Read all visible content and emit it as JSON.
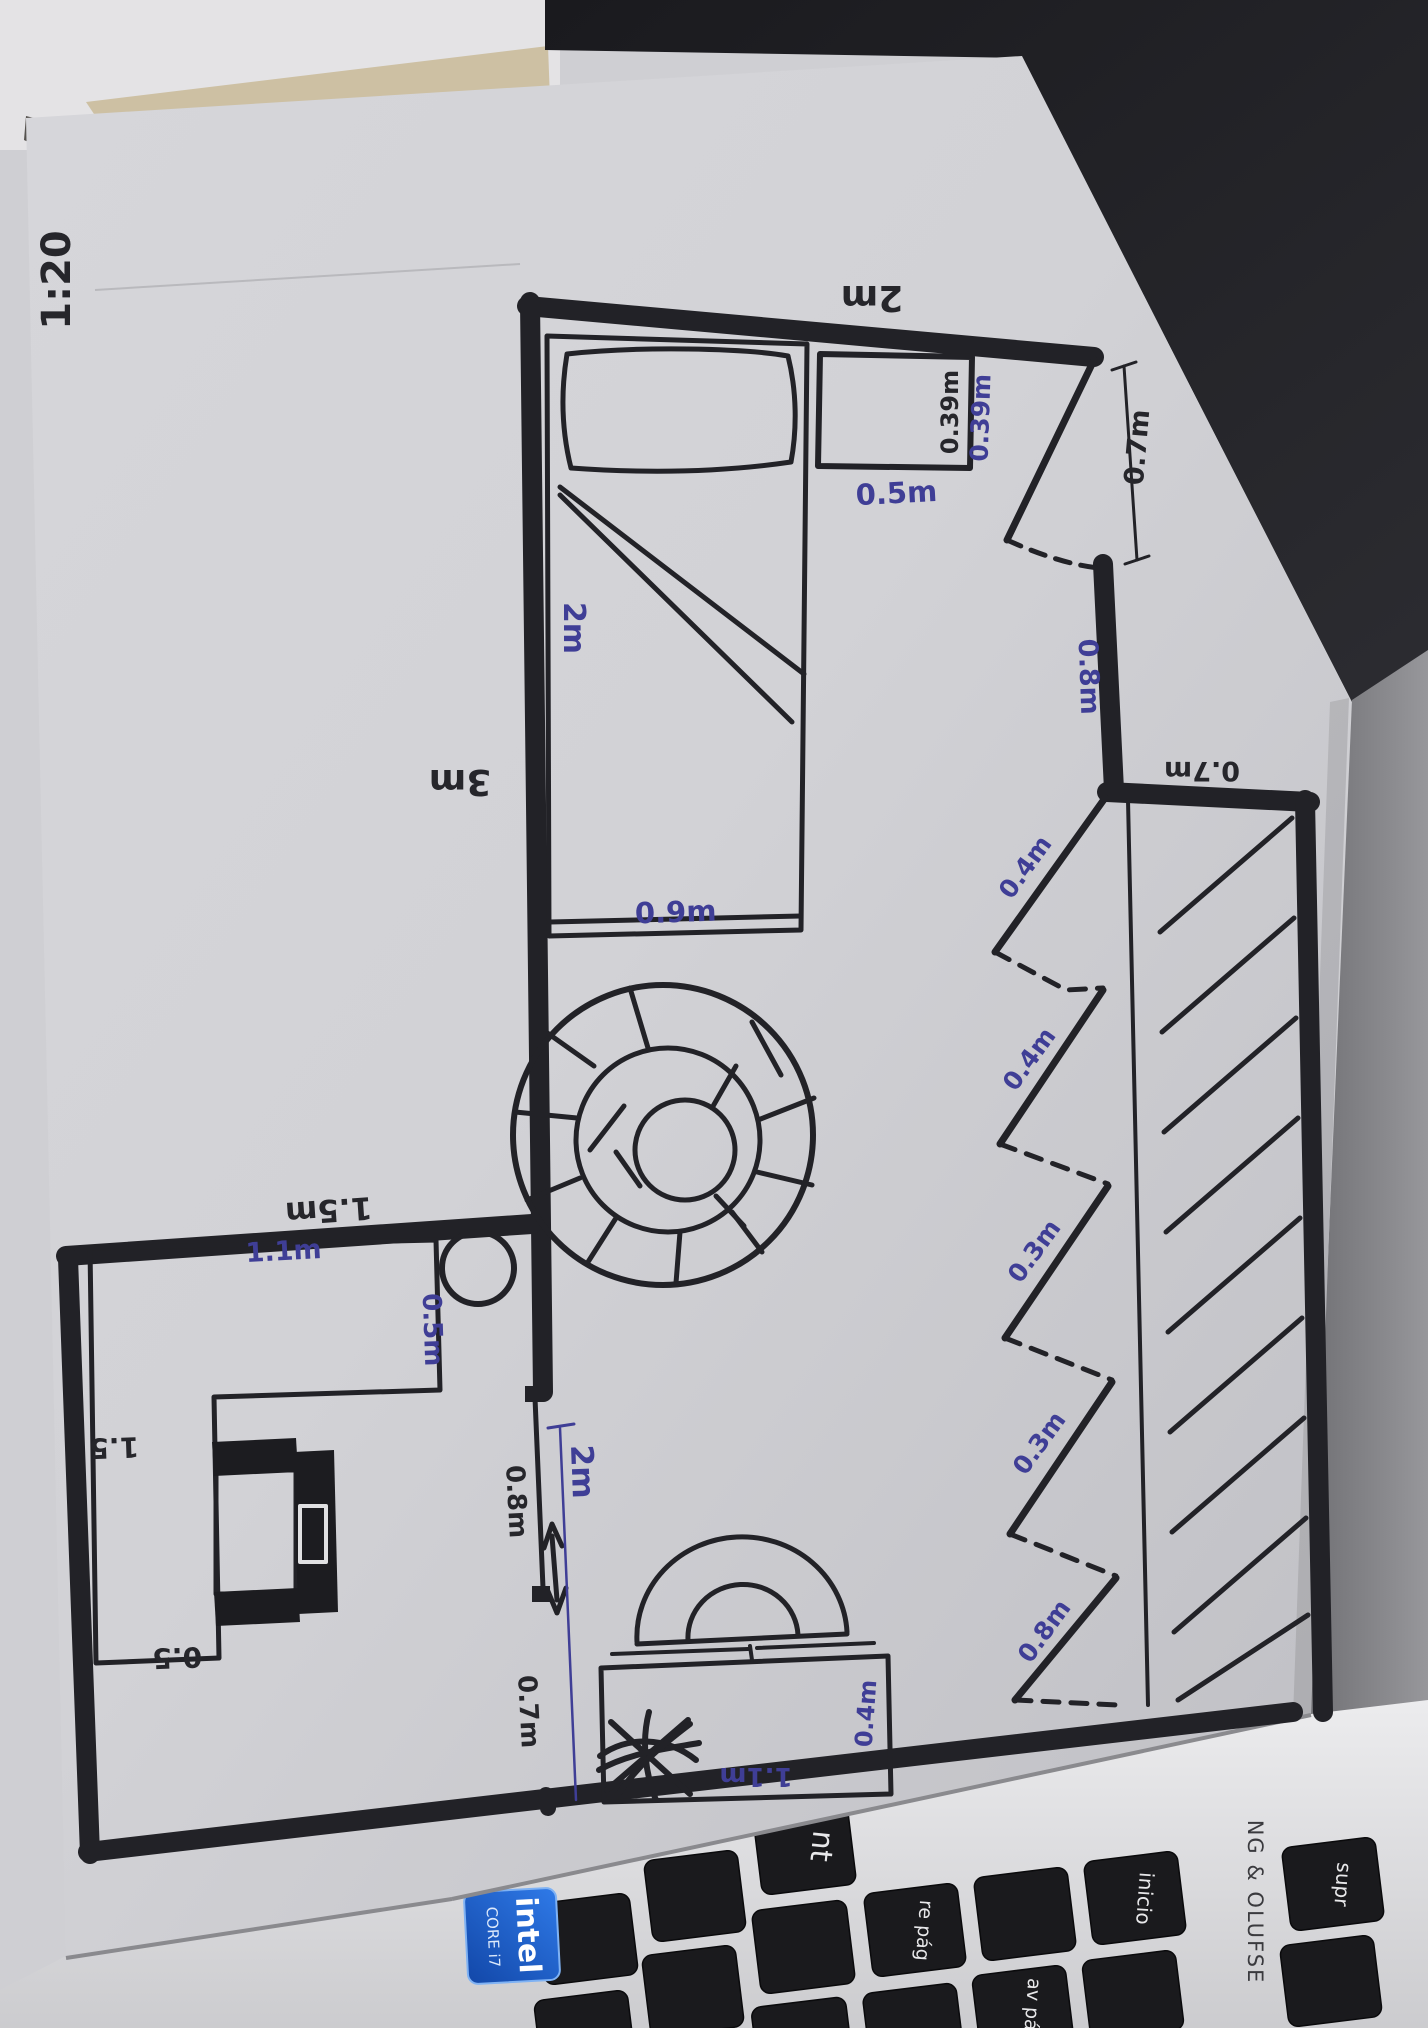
{
  "photo": {
    "scale_label": "1:20"
  },
  "floorplan": {
    "room": {
      "top_width": "2m",
      "left_height": "3m"
    },
    "bed": {
      "length": "2m",
      "width": "0.9m"
    },
    "side_table": {
      "width": "0.5m",
      "depth_black": "0.39m",
      "depth_blue": "0.39m"
    },
    "door_top": {
      "opening": "0.7m",
      "wall_below": "0.8m"
    },
    "alcove": {
      "depth": "0.7m"
    },
    "closet_panels": [
      "0.4m",
      "0.4m",
      "0.3m",
      "0.3m",
      "0.8m"
    ],
    "door_left": {
      "total": "2m",
      "upper": "0.8m",
      "lower": "0.7m"
    },
    "desk_room": {
      "top_wall": "1.5m",
      "desk_top": "1.1m",
      "desk_right": "0.5m",
      "desk_left": "1.5",
      "desk_bottom": "0.5"
    },
    "dresser": {
      "width": "1.1m",
      "depth": "0.4m"
    }
  },
  "laptop": {
    "keys": {
      "enter_partial": "nt",
      "re_pag": "re pág",
      "inicio": "inicio",
      "av_pag": "av pág",
      "supr": "supr"
    },
    "brand_strip": "NG & OLUFSE",
    "sticker": {
      "brand": "intel",
      "line2": "CORE i7"
    }
  }
}
